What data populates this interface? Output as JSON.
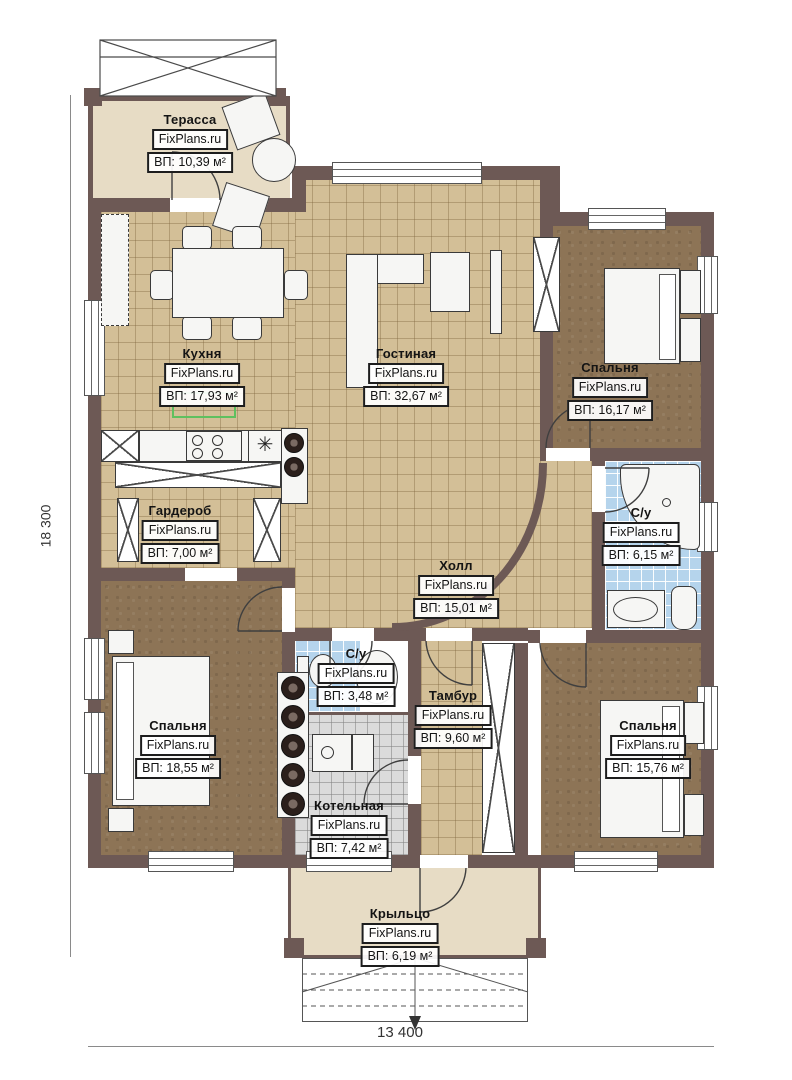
{
  "plan": {
    "watermark": "FixPlans.ru",
    "dimensions": {
      "height_label": "18 300",
      "width_label": "13 400"
    },
    "rooms": [
      {
        "name": "Терасса",
        "area": "ВП: 10,39 м²"
      },
      {
        "name": "Кухня",
        "area": "ВП: 17,93 м²"
      },
      {
        "name": "Гостиная",
        "area": "ВП: 32,67 м²"
      },
      {
        "name": "Спальня",
        "area": "ВП: 16,17 м²"
      },
      {
        "name": "Гардероб",
        "area": "ВП: 7,00 м²"
      },
      {
        "name": "С/у",
        "area": "ВП: 6,15 м²"
      },
      {
        "name": "Холл",
        "area": "ВП: 15,01 м²"
      },
      {
        "name": "С/у",
        "area": "ВП: 3,48 м²"
      },
      {
        "name": "Тамбур",
        "area": "ВП: 9,60 м²"
      },
      {
        "name": "Спальня",
        "area": "ВП: 18,55 м²"
      },
      {
        "name": "Котельная",
        "area": "ВП: 7,42 м²"
      },
      {
        "name": "Спальня",
        "area": "ВП: 15,76 м²"
      },
      {
        "name": "Крыльцо",
        "area": "ВП: 6,19 м²"
      }
    ],
    "icons": {
      "kitchen_sink": "✳"
    },
    "colors": {
      "wall": "#6d5955",
      "tile_tan": "#d3bf97",
      "carpet_brown": "#8d7456",
      "bath_blue": "#b5d4ec",
      "boiler_grey": "#dbdbdb",
      "terrace_beige": "#e7dcc5",
      "highlight_green": "#5fc05f"
    }
  }
}
